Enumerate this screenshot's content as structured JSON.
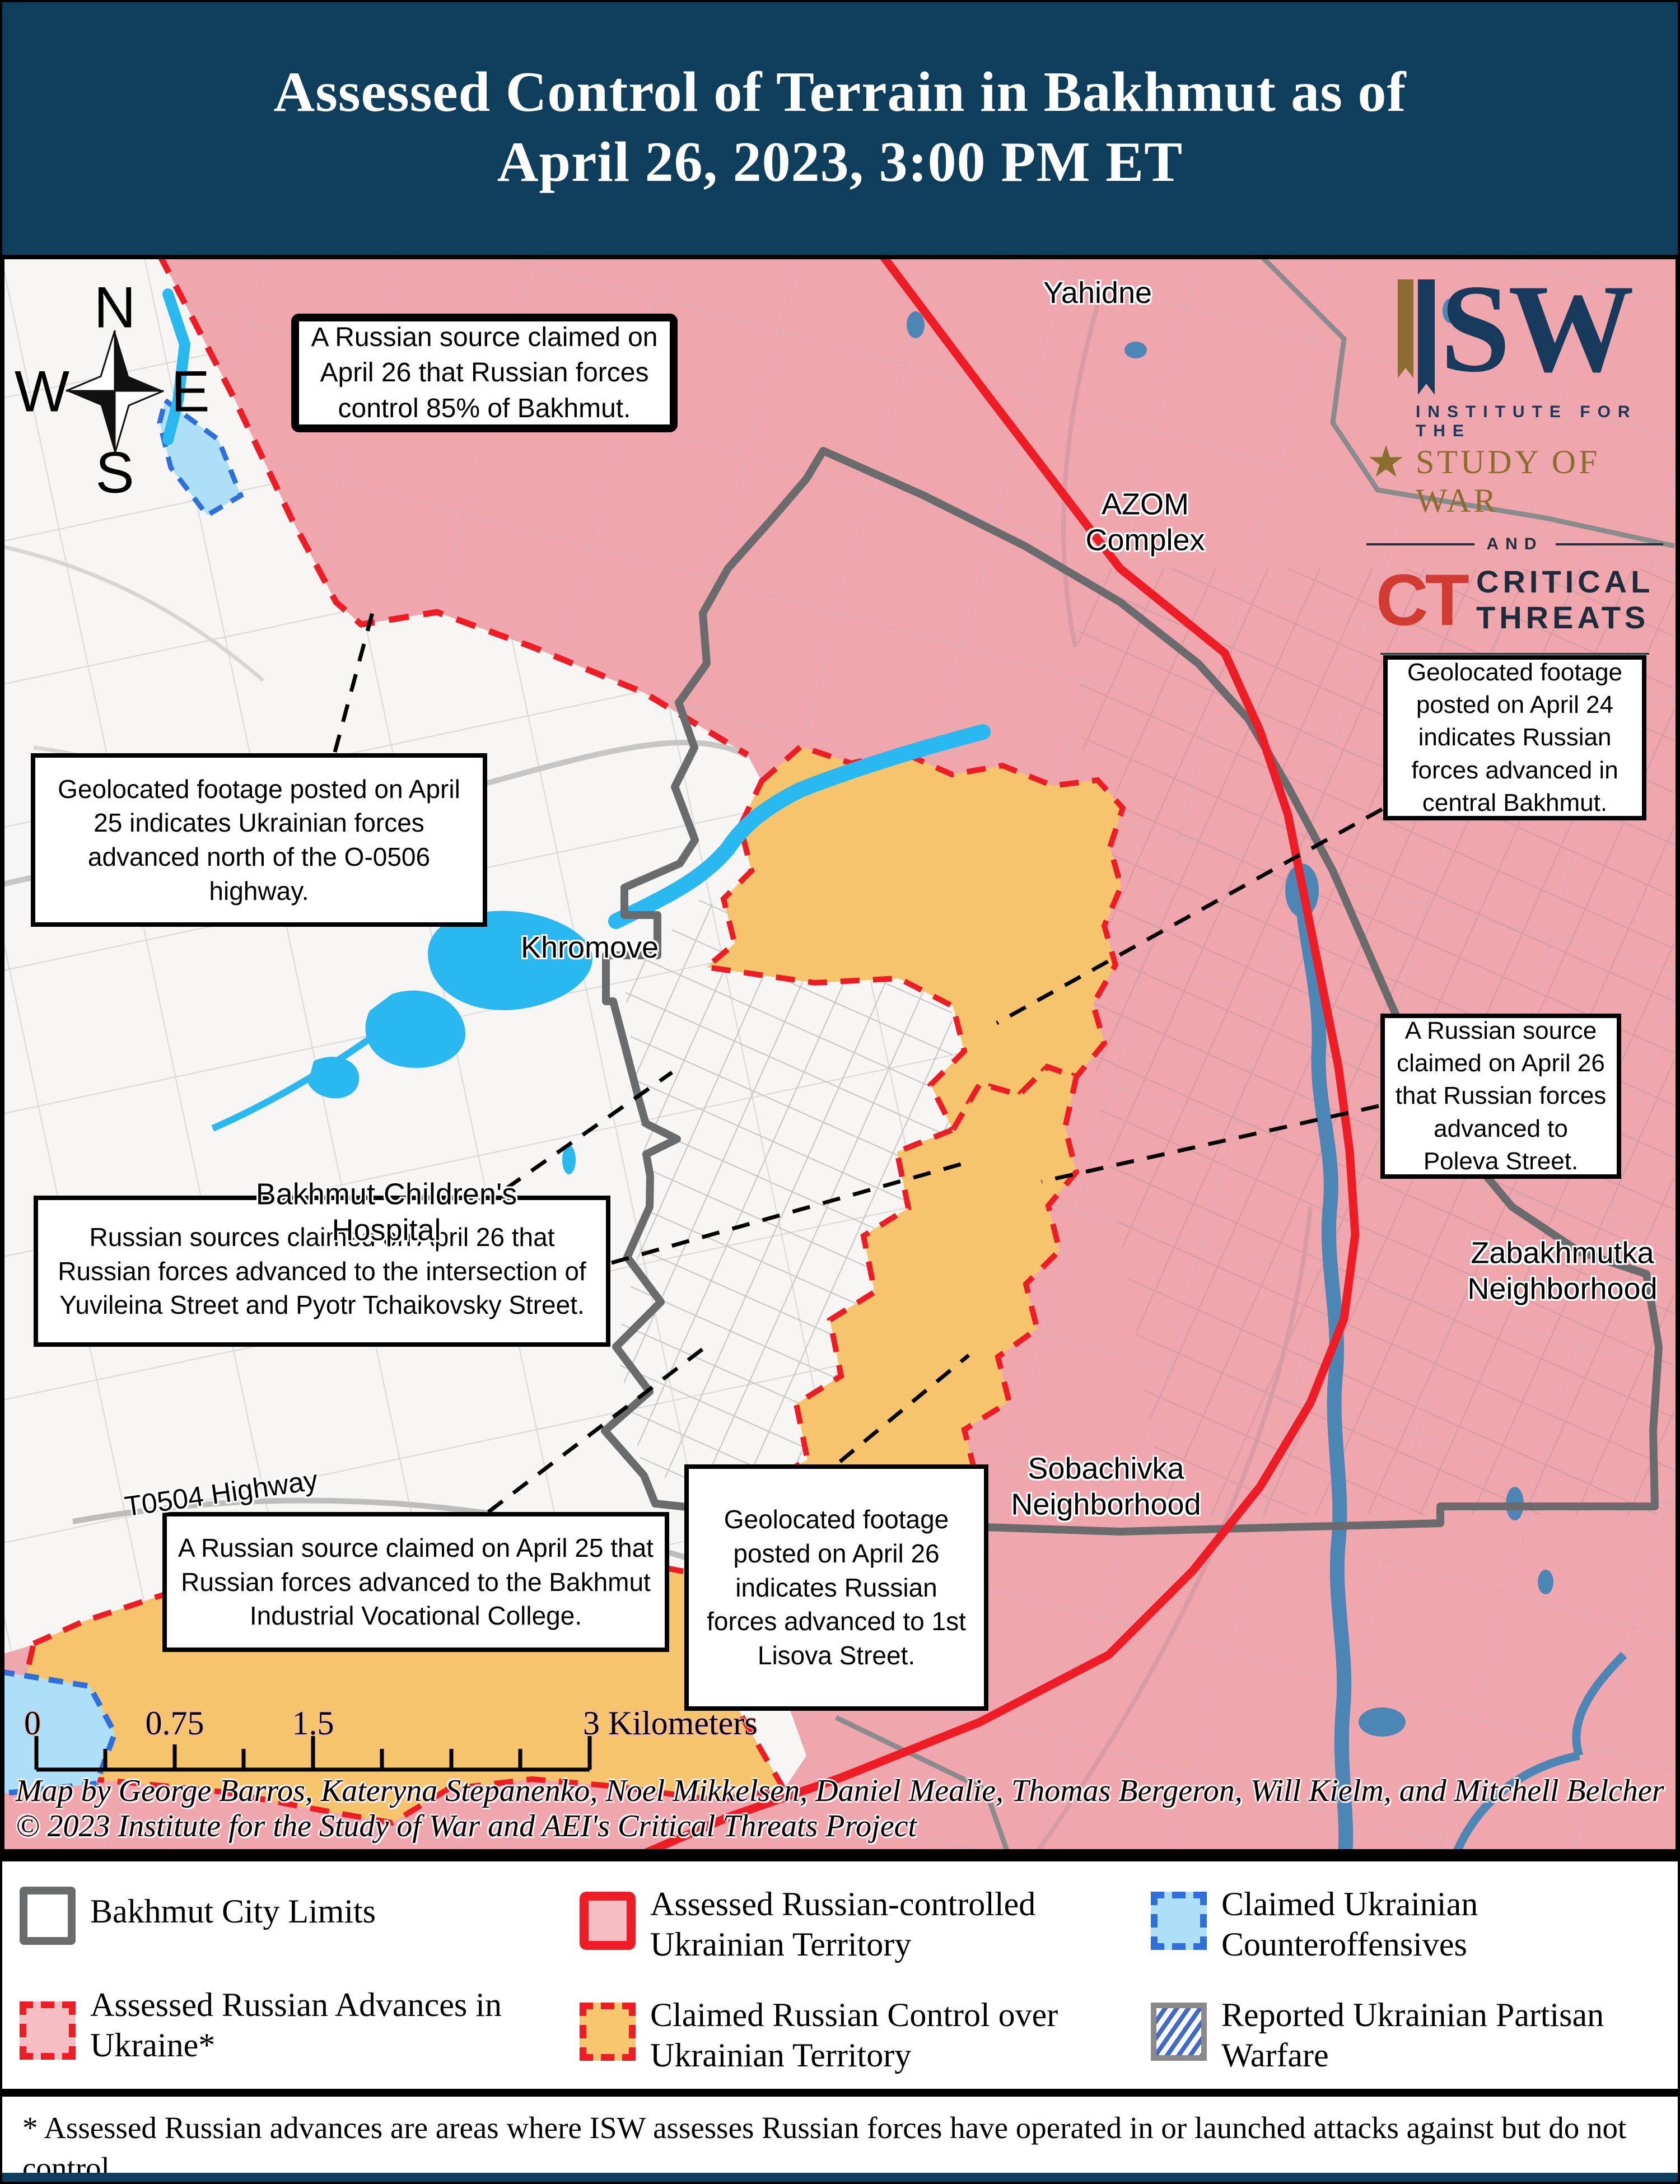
{
  "title": {
    "line1": "Assessed Control of Terrain in Bakhmut as of",
    "line2": "April 26, 2023, 3:00 PM ET"
  },
  "logo": {
    "isw_suffix": "SW",
    "institute": "INSTITUTE FOR THE",
    "study": "STUDY OF WAR",
    "and": "AND",
    "ct": "CT",
    "critical": "CRITICAL",
    "threats": "THREATS",
    "fund_line1": "THE DR. JACK LONDON",
    "fund_line2": "GEOSPATIAL FUND",
    "star": "★"
  },
  "compass": {
    "n": "N",
    "s": "S",
    "e": "E",
    "w": "W"
  },
  "callouts": {
    "c1": "A Russian source claimed on April 26 that Russian forces control 85% of Bakhmut.",
    "c2": "Geolocated footage posted on April 25 indicates Ukrainian forces advanced north of the O-0506 highway.",
    "c3": "Russian sources claimed on April 26 that Russian forces advanced to the intersection of Yuvileina Street and Pyotr Tchaikovsky Street.",
    "c4": "A Russian source claimed on April 25 that Russian forces advanced to the Bakhmut Industrial Vocational College.",
    "c5": "Geolocated footage posted on April 26 indicates Russian forces advanced to 1st Lisova Street.",
    "c6": "Geolocated footage posted on April 24 indicates Russian forces advanced in central Bakhmut.",
    "c7": "A Russian source claimed on April 26 that Russian forces advanced to Poleva Street."
  },
  "labels": {
    "yahidne": "Yahidne",
    "azom1": "AZOM",
    "azom2": "Complex",
    "khromove": "Khromove",
    "hospital1": "Bakhmut Children's",
    "hospital2": "Hospital",
    "zabakhmutka1": "Zabakhmutka",
    "zabakhmutka2": "Neighborhood",
    "sobachivka1": "Sobachivka",
    "sobachivka2": "Neighborhood",
    "t0504": "T0504 Highway"
  },
  "scalebar": {
    "t0": "0",
    "t075": "0.75",
    "t15": "1.5",
    "t3": "3 Kilometers"
  },
  "attribution": {
    "line1": "Map by George Barros, Kateryna Stepanenko, Noel Mikkelsen, Daniel Mealie, Thomas Bergeron, Will Kielm, and Mitchell Belcher",
    "line2": "© 2023 Institute for the Study of War and AEI's Critical Threats Project"
  },
  "legend": {
    "items": [
      {
        "label": "Bakhmut City Limits"
      },
      {
        "label": "Assessed Russian Advances in Ukraine*"
      },
      {
        "label": "Assessed Russian-controlled Ukrainian Territory"
      },
      {
        "label": "Claimed Russian Control over Ukrainian Territory"
      },
      {
        "label": "Claimed Ukrainian Counteroffensives"
      },
      {
        "label": "Reported Ukrainian Partisan Warfare"
      }
    ]
  },
  "footnote": "* Assessed Russian advances are areas where ISW assesses Russian forces have operated in or launched attacks against but do not control.",
  "colors": {
    "header_navy": "#0e3e5c",
    "russian_controlled_pink": "#efa6ad",
    "claimed_russian_orange": "#f6c46d",
    "ukrainian_white": "#f7f6f4",
    "claimed_ukr_counter_blue": "#ade0f8",
    "water_cyan": "#29b8f0",
    "river_steel_blue": "#4c86b4",
    "front_line_red": "#ee1c25",
    "city_limits_gray": "#6a6b6d"
  }
}
